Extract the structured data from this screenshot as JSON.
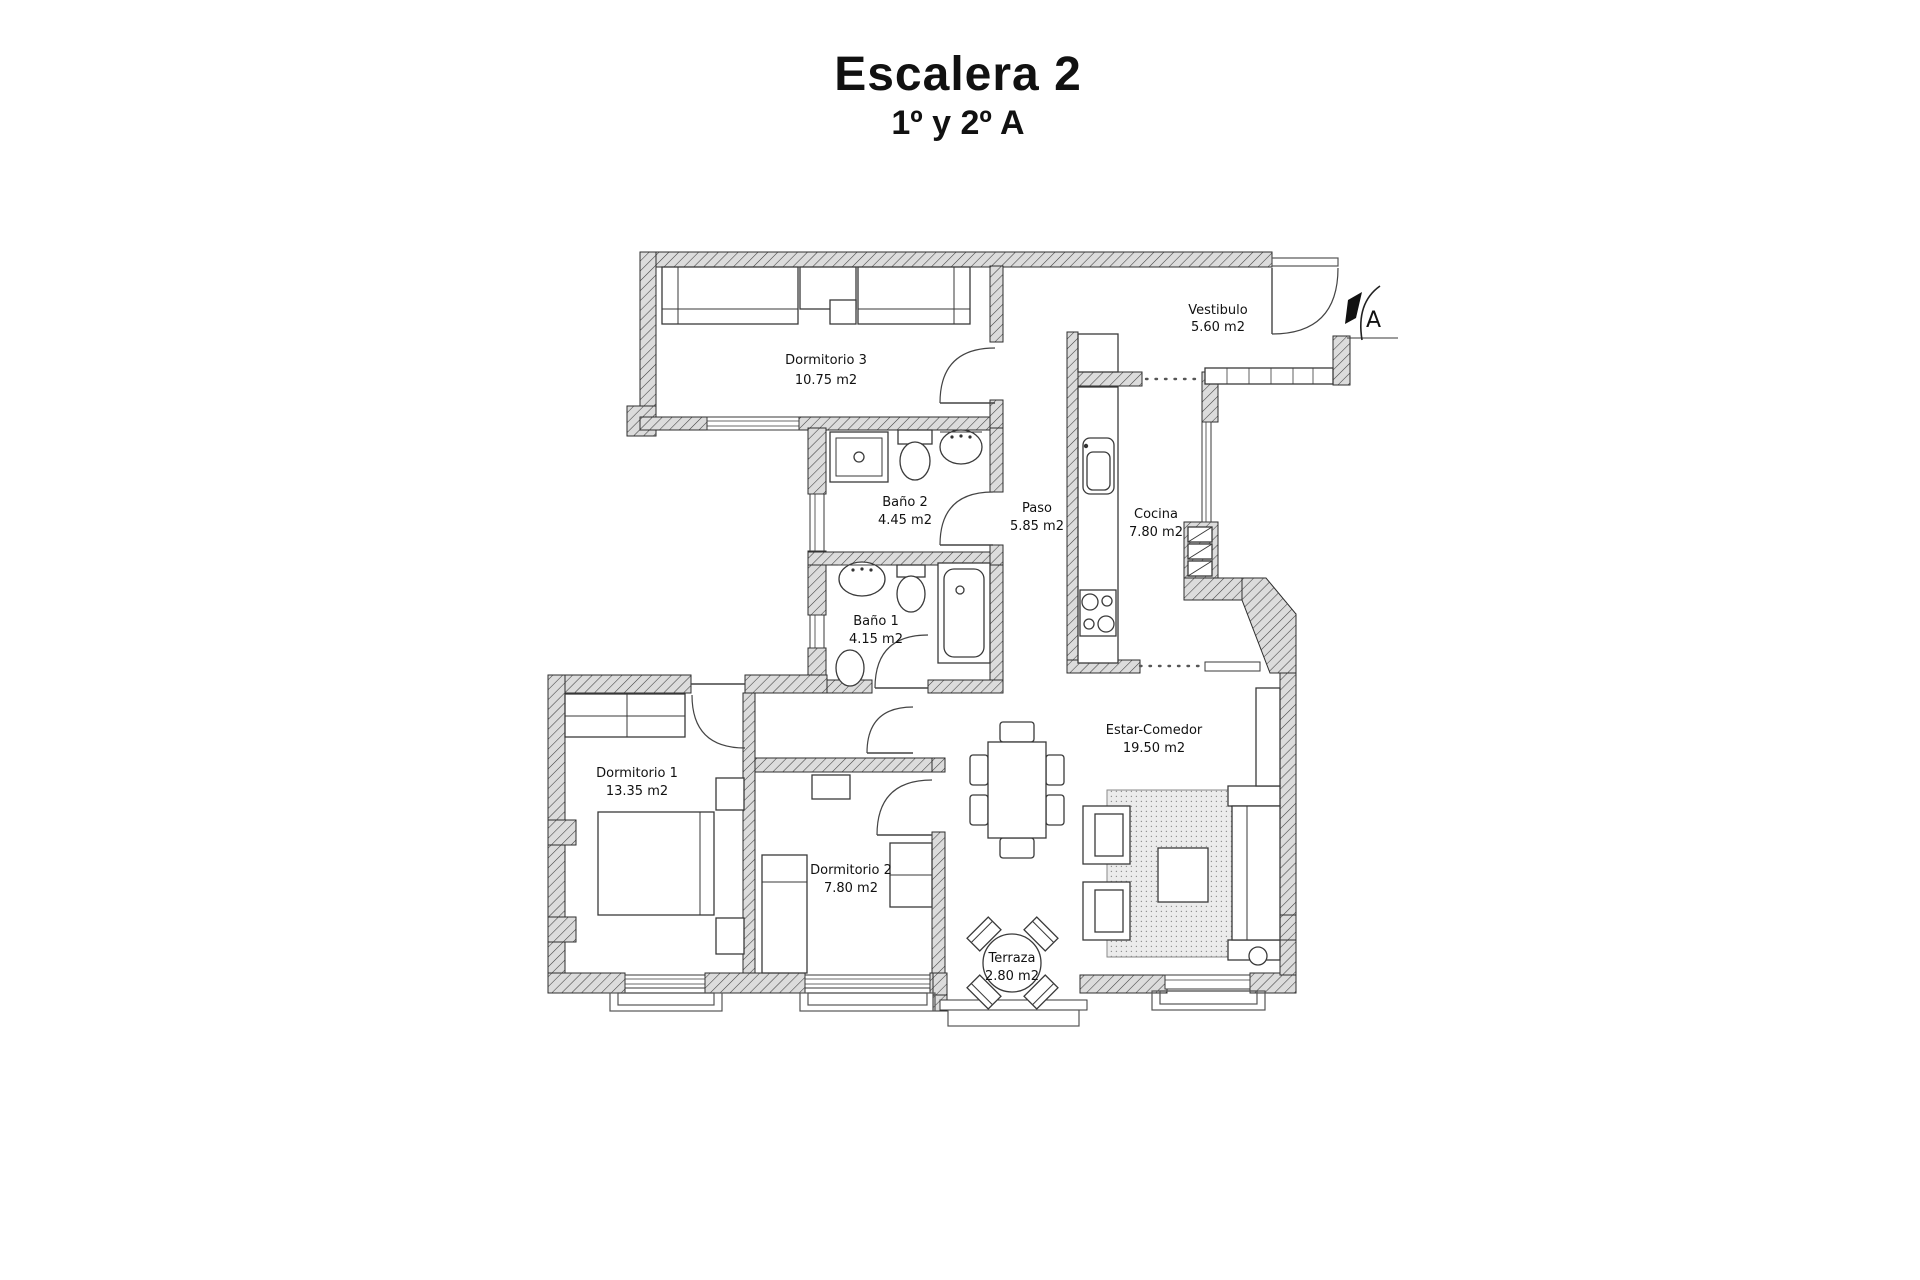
{
  "page_title": {
    "title": "Escalera 2",
    "subtitle": "1º y 2º A"
  },
  "entrance": {
    "label": "A"
  },
  "rooms": [
    {
      "id": "dormitorio-3",
      "name": "Dormitorio 3",
      "area": "10.75 m2"
    },
    {
      "id": "vestibulo",
      "name": "Vestibulo",
      "area": "5.60 m2"
    },
    {
      "id": "bano-2",
      "name": "Baño 2",
      "area": "4.45 m2"
    },
    {
      "id": "paso",
      "name": "Paso",
      "area": "5.85 m2"
    },
    {
      "id": "cocina",
      "name": "Cocina",
      "area": "7.80 m2"
    },
    {
      "id": "bano-1",
      "name": "Baño 1",
      "area": "4.15 m2"
    },
    {
      "id": "dormitorio-1",
      "name": "Dormitorio 1",
      "area": "13.35 m2"
    },
    {
      "id": "dormitorio-2",
      "name": "Dormitorio 2",
      "area": "7.80 m2"
    },
    {
      "id": "estar-comedor",
      "name": "Estar-Comedor",
      "area": "19.50 m2"
    },
    {
      "id": "terraza",
      "name": "Terraza",
      "area": "2.80 m2"
    }
  ],
  "colors": {
    "wall_fill": "#dcdcdc",
    "wall_line": "#3f3f3f",
    "ink": "#111111",
    "rug": "#ececec"
  }
}
